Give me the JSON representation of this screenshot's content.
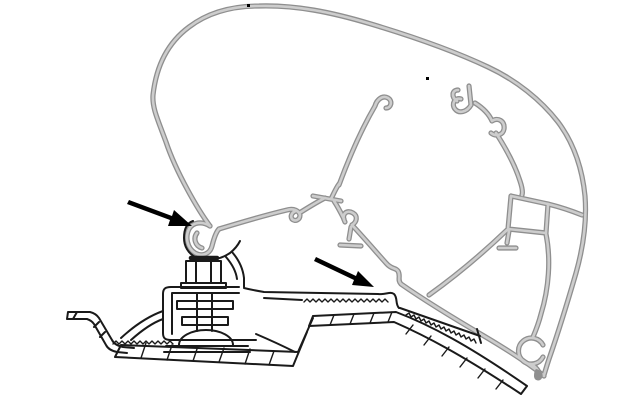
{
  "meta": {
    "description": "Technical cross-section line drawing of an awning case aluminium extrusion profile (grey) clipped onto a roof-mount adapter bracket (black) that is bolted to a van roof rail; two black arrows point at the front and rear clip-in hook engagement points. No text labels are present in the figure.",
    "background": "#ffffff"
  },
  "palette": {
    "ink": "#1a1a1a",
    "profile_edge": "#8f8f8f",
    "profile_core": "#cdcdcd",
    "arrow": "#000000"
  },
  "annotations": {
    "arrow_front_hook": {
      "tail_x": 129,
      "tail_y": 201,
      "tip_x": 192,
      "tip_y": 226
    },
    "arrow_rear_hook": {
      "tail_x": 316,
      "tail_y": 259,
      "tip_x": 374,
      "tip_y": 287
    }
  },
  "drawing": {
    "viewbox": "0 0 640 400",
    "paths": {
      "shell_outer": {
        "d": "M 210,226 C 198,210 176,172 166,142 C 158,120 152,108 153,95 C 156,68 166,44 189,27 C 206,14 229,6 259,6 C 296,5 331,12 371,24 C 411,36 452,50 488,67 C 516,80 541,100 558,122 C 573,142 582,166 585,196 C 587,221 583,248 576,273 C 567,304 557,336 549,359 C 546,368 545,372 544,375"
      },
      "main_hook": {
        "d": "M 210,226 C 202,221 193,222 189,229 C 185,237 187,248 195,253 C 202,257 210,254 212,246 M 197,233 C 193,238 195,246 202,248 M 212,246 C 214,238 216,232 219,229"
      },
      "lip": {
        "d": "M 219,229 C 242,222 266,215 287,210 C 294,208 299,211 300,215 C 300,220 295,222 292,219 C 290,216 292,212 296,211"
      },
      "link_tbar": {
        "d": "M 301,212 C 309,207 317,202 325,198 M 313,196 L 341,201 M 331,199 C 334,193 336,188 339,184 M 334,201 C 338,207 341,213 344,219"
      },
      "web_a": {
        "d": "M 339,185 C 349,158 361,130 375,106 C 377,99 383,95 388,98 C 393,101 391,108 386,108"
      },
      "claw2": {
        "d": "M 345,222 C 341,215 346,209 353,213 C 358,216 357,222 352,225"
      },
      "inv_t": {
        "d": "M 351,227 L 349,239 M 340,245 L 361,246"
      },
      "rail": {
        "d": "M 352,225 C 366,240 377,253 386,263 C 392,270 395,267 398,271 C 401,276 397,280 401,284 C 424,300 455,319 484,336 C 506,349 524,361 535,369 C 540,373 543,375 544,376"
      },
      "stub_claws": {
        "d": "M 469,86 L 471,105 M 471,105 C 467,112 459,114 455,109 C 451,104 455,97 461,99 M 457,101 C 451,97 452,90 458,90"
      },
      "web_b": {
        "d": "M 475,103 C 483,108 489,114 492,121 C 498,117 505,121 504,129 C 503,135 496,137 491,133 M 496,133 C 505,147 515,165 520,181 C 522,187 523,192 522,195"
      },
      "box_chamber": {
        "d": "M 511,196 L 548,204 L 546,233 L 508,229 L 511,196"
      },
      "box_to_shell": {
        "d": "M 548,204 C 560,207 572,211 582,215"
      },
      "t_stub": {
        "d": "M 509,231 L 507,243 M 499,248 L 516,248"
      },
      "web_c": {
        "d": "M 507,230 C 484,252 457,275 429,295"
      },
      "web_d": {
        "d": "M 546,234 C 551,259 549,288 541,314 C 539,322 536,330 533,337"
      },
      "curl": {
        "d": "M 543,345 A 13,13 0 1 0 543,357 M 531,364 C 536,367 539,371 540,375"
      },
      "sheet": {
        "d": "M 68,312 L 90,312 C 94,313 97,315 99,318 L 112,340 C 114,344 118,346 123,347 L 134,348 M 67,319 L 87,319 C 90,320 92,321 94,324 L 106,345 C 108,349 112,351 117,352 L 127,353 M 68,312 L 67,319 M 77,312 L 73,319 M 99,322 L 94,327 M 105,332 L 100,337"
      },
      "band_b": {
        "d": "M 121,345 L 298,352 M 115,357 L 293,366 M 121,345 L 115,357 M 298,352 L 313,318 M 293,366 L 307,332"
      },
      "band_b_rungs": {
        "d": "M 146,343 L 141,358 M 172,345 L 167,360 M 198,346 L 193,361 M 224,348 L 219,362 M 250,349 L 245,364 M 274,351 L 269,365"
      },
      "ladder": {
        "d": "M 313,316 L 396,312 C 430,325 468,345 527,386 M 309,326 L 394,322 C 426,336 462,355 521,394 M 313,316 L 309,326 M 527,386 L 521,394"
      },
      "ladder_rungs": {
        "d": "M 334,315 L 330,325 M 354,314 L 350,324 M 374,313 L 370,323 M 392,312 L 388,322 M 413,325 L 406,334 M 431,336 L 424,345 M 449,347 L 442,356 M 467,358 L 460,367 M 485,369 L 478,378 M 503,380 L 496,389"
      },
      "foot_left": {
        "d": "M 163,311 C 149,316 134,326 121,338 M 163,319 C 152,323 141,331 131,340"
      },
      "zigzag_foot": {
        "d": "M 113,344 l 3,-3 3,3 3,-3 3,3 3,-3 3,3 3,-3 3,3 3,-3 3,3 3,-3 3,3 3,-3 3,3 3,-3 3,3 3,-3 3,3 3,-3 3,3"
      },
      "zigzag_arm": {
        "d": "M 304,302 l 3,-3 3,3 3,-3 3,3 3,-3 3,3 3,-3 3,3 3,-3 3,3 3,-3 3,3 3,-3 3,3 3,-3 3,3 3,-3 3,3 3,-3 3,3 3,-3 3,3 3,-3 3,3 3,-3 3,3 3,-3 3,3"
      },
      "zigzag_rail": {
        "d": "M 406,315 l 3,-2 2,4 3,-2 2,4 3,-2 2,4 3,-2 2,4 3,-2 2,4 3,-2 2,4 3,-2 2,4 3,-2 2,4 3,-2 2,4 3,-2 2,4 3,-2 2,4 3,-2 2,4 3,-2 2,4 3,-2 2,4"
      },
      "grip_outline": {
        "d": "M 400,308 L 480,336 M 477,329 L 481,343"
      },
      "clamp": {
        "d": "M 239,287 L 171,287 C 165,287 163,289 163,294 L 163,333 C 163,338 165,340 171,340 L 256,340 M 239,293 L 172,293 L 172,334"
      },
      "right_leg": {
        "d": "M 256,334 C 270,340 283,346 295,352"
      },
      "arm_right": {
        "d": "M 244,288 C 252,290 258,291 264,292 L 378,294 C 386,295 390,291 394,294 C 398,298 395,304 399,308 M 264,298 L 302,300"
      },
      "cradle": {
        "d": "M 193,221 C 187,223 184,229 184,238 C 184,246 188,253 195,257 C 205,262 220,260 230,253 C 235,249 238,245 240,241 M 232,252 C 239,260 243,269 244,278 L 244,287 M 226,257 C 232,264 236,271 237,279"
      },
      "nut_cap": {
        "d": "M 191,258 L 217,258"
      },
      "nut": {
        "d": "M 186,261 L 221,261 L 221,283 L 186,283 L 186,261 M 196,261 L 196,283 M 211,261 L 211,283 M 181,283 L 226,283 L 226,288 L 181,288 L 181,283"
      },
      "bolt_stack": {
        "d": "M 177,301 L 233,301 L 233,309 L 177,309 L 177,301 M 182,317 L 228,317 L 228,325 L 182,325 L 182,317 M 197,293 L 197,331 M 212,293 L 212,331"
      },
      "dome_washer": {
        "d": "M 179,345 A 27,15 0 0 1 233,345 M 166,346 L 248,346 M 164,352 L 250,352"
      },
      "arrow1": {
        "d": "M 129,200 L 172,216 L 174,210 L 192,226 L 168,226 L 170,220 L 127,204 Z"
      },
      "arrow2": {
        "d": "M 316,257 L 356,276 L 358,271 L 374,287 L 352,285 L 354,280 L 314,261 Z"
      },
      "speck_top": {
        "d": "M 247,4 h 3 v 3 h -3 Z"
      },
      "speck_inner": {
        "d": "M 426,77 h 3 v 3 h -3 Z"
      },
      "rail_tip_ball": {
        "d": "M 536,369 C 541,370 544,374 542,378 C 540,382 534,381 534,376 C 534,372 535,370 536,369 Z"
      }
    }
  }
}
